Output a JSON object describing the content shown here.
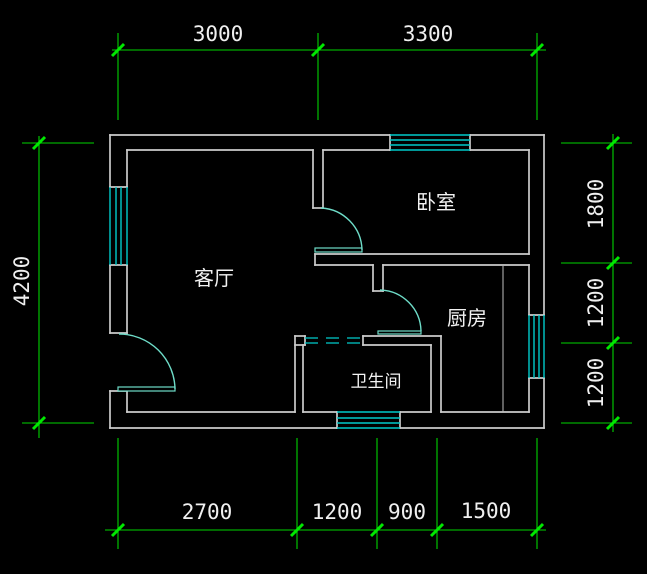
{
  "drawing": {
    "type": "cad-floor-plan",
    "background_color": "#000000",
    "wall_color": "#cccccc",
    "window_color": "#00cbcb",
    "door_color": "#6edcc8",
    "dimension_color": "#00d400",
    "text_color": "#f0f0f0",
    "rooms": [
      {
        "id": "living-room",
        "label": "客厅"
      },
      {
        "id": "bedroom",
        "label": "卧室"
      },
      {
        "id": "kitchen",
        "label": "厨房"
      },
      {
        "id": "bathroom",
        "label": "卫生间"
      }
    ],
    "dimensions": {
      "top": [
        "3000",
        "3300"
      ],
      "left": [
        "4200"
      ],
      "right": [
        "1800",
        "1200",
        "1200"
      ],
      "bottom": [
        "2700",
        "1200",
        "900",
        "1500"
      ]
    }
  }
}
